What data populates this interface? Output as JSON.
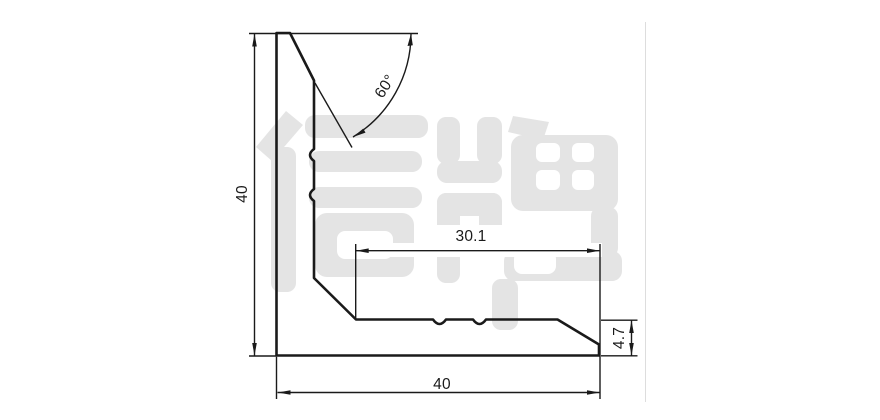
{
  "drawing": {
    "dimension_labels": {
      "height": "40",
      "width": "40",
      "flange_length": "30.1",
      "thickness": "4.7",
      "angle": "60°"
    },
    "watermark_text": "信牌",
    "colors": {
      "line": "#1a1a1a",
      "watermark": "#e4e4e4",
      "sheet_border": "#dddddd",
      "background": "#ffffff"
    }
  }
}
